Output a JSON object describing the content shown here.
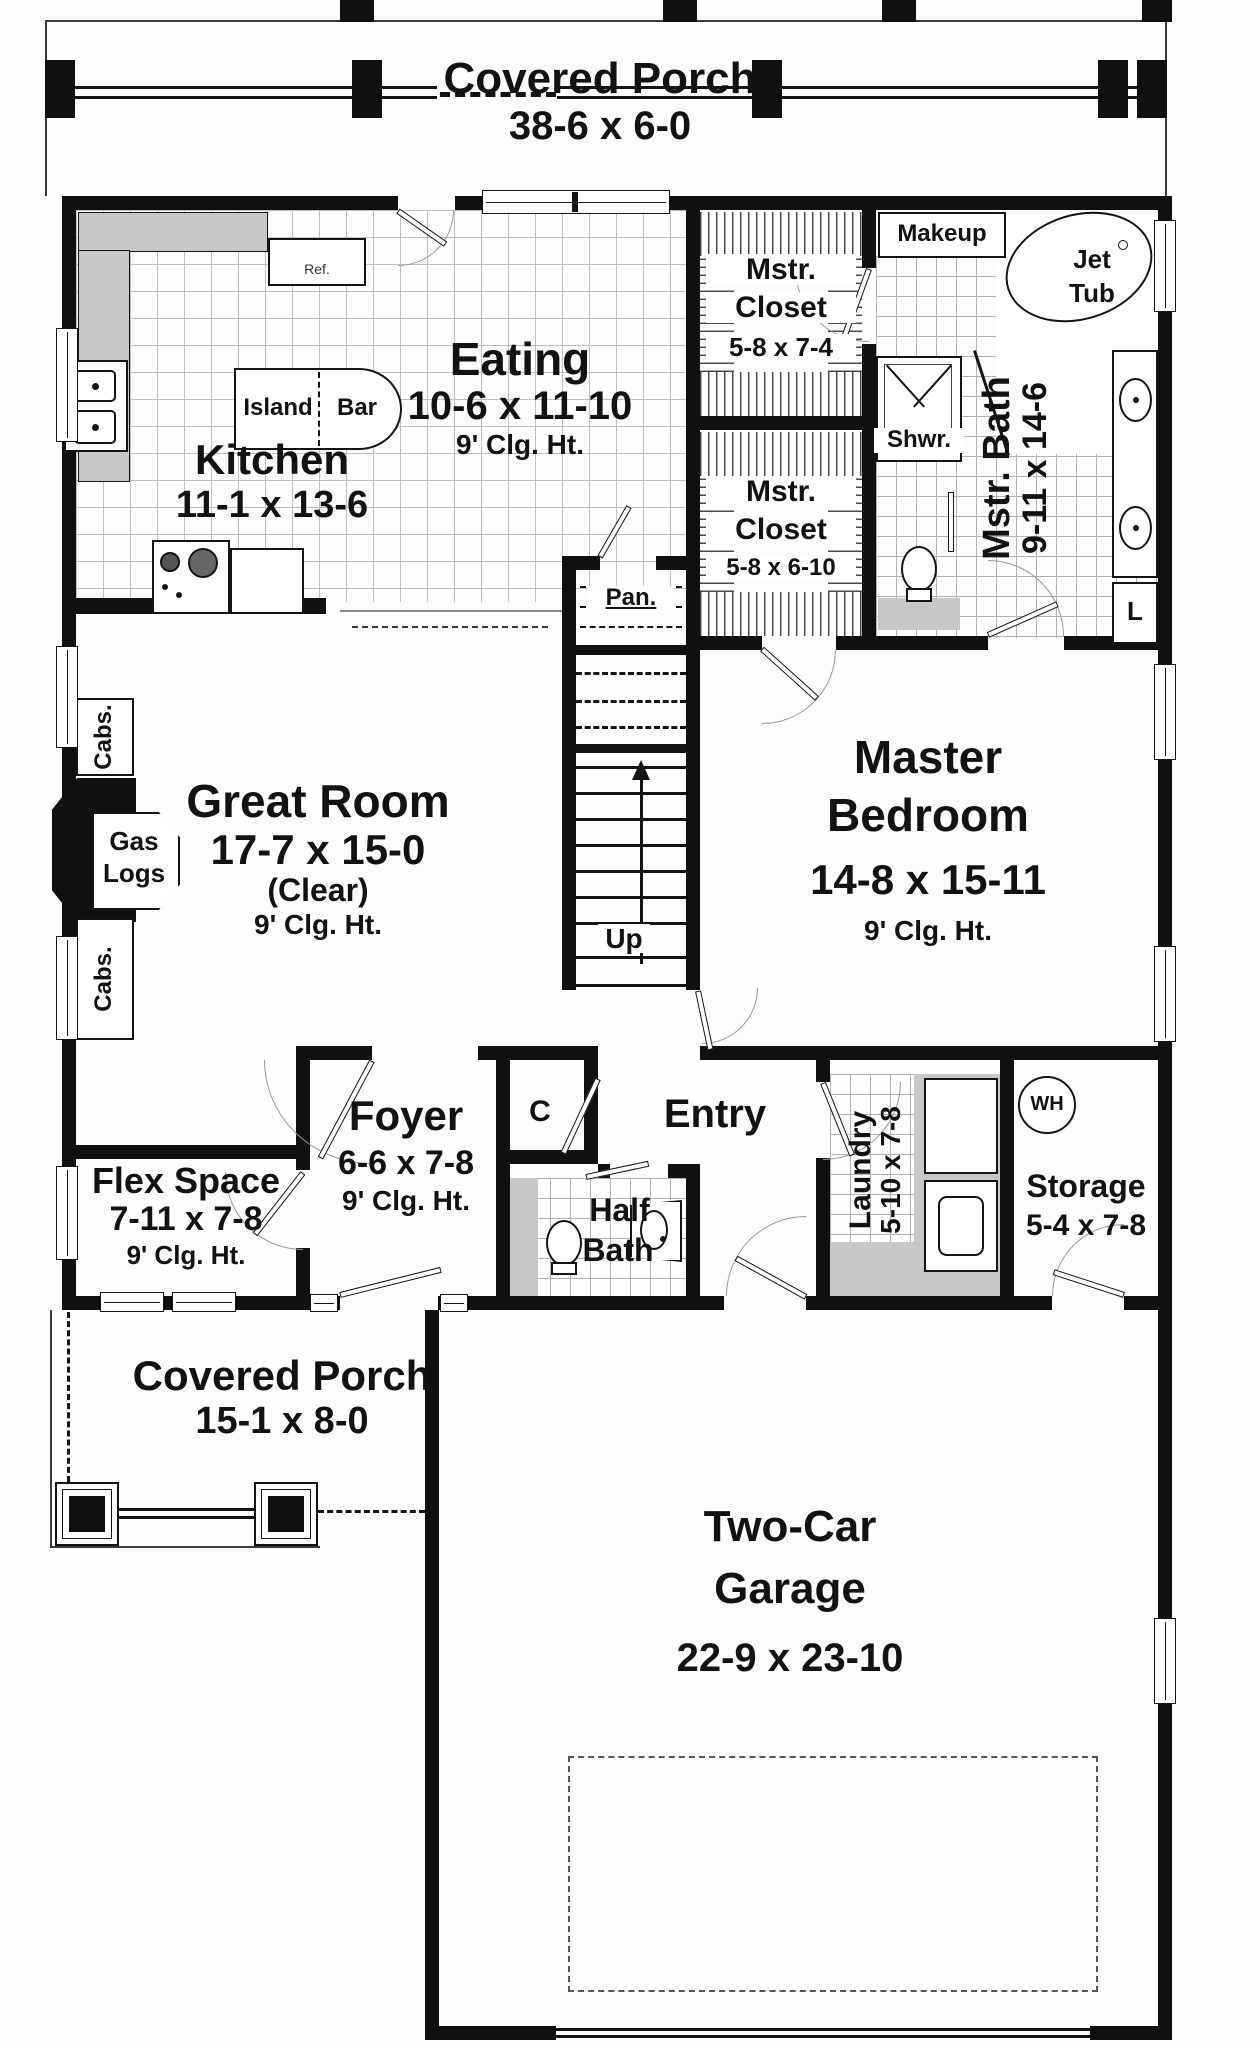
{
  "plan": {
    "porch_top": {
      "name": "Covered Porch",
      "dims": "38-6 x 6-0"
    },
    "eating": {
      "name": "Eating",
      "dims": "10-6 x 11-10",
      "clg": "9' Clg. Ht."
    },
    "kitchen": {
      "name": "Kitchen",
      "dims": "11-1 x 13-6"
    },
    "island": {
      "left": "Island",
      "right": "Bar"
    },
    "ref_label": "Ref.",
    "mstr_closet_1": {
      "line1": "Mstr.",
      "line2": "Closet",
      "dims": "5-8 x 7-4"
    },
    "makeup": "Makeup",
    "jet_tub": {
      "line1": "Jet",
      "line2": "Tub"
    },
    "shower": "Shwr.",
    "mstr_bath": {
      "name": "Mstr. Bath",
      "dims": "9-11 x 14-6"
    },
    "mstr_closet_2": {
      "line1": "Mstr.",
      "line2": "Closet",
      "dims": "5-8 x 6-10"
    },
    "pantry": "Pan.",
    "cabs_top": "Cabs.",
    "cabs_bottom": "Cabs.",
    "gas_logs": {
      "line1": "Gas",
      "line2": "Logs"
    },
    "great_room": {
      "name": "Great Room",
      "dims": "17-7 x 15-0",
      "note": "(Clear)",
      "clg": "9' Clg. Ht."
    },
    "stairs": {
      "label": "Up"
    },
    "master_bedroom": {
      "line1": "Master",
      "line2": "Bedroom",
      "dims": "14-8 x 15-11",
      "clg": "9' Clg. Ht."
    },
    "linen": "L",
    "flex_space": {
      "name": "Flex Space",
      "dims": "7-11 x 7-8",
      "clg": "9' Clg. Ht."
    },
    "foyer": {
      "name": "Foyer",
      "dims": "6-6 x 7-8",
      "clg": "9' Clg. Ht."
    },
    "closet_c": "C",
    "entry": "Entry",
    "half_bath": {
      "line1": "Half",
      "line2": "Bath"
    },
    "laundry": {
      "name": "Laundry",
      "dims": "5-10 x 7-8"
    },
    "water_heater": "WH",
    "storage": {
      "name": "Storage",
      "dims": "5-4 x 7-8"
    },
    "porch_bottom": {
      "name": "Covered Porch",
      "dims": "15-1 x 8-0"
    },
    "garage": {
      "line1": "Two-Car",
      "line2": "Garage",
      "dims": "22-9 x 23-10"
    }
  },
  "colors": {
    "wall": "#101010",
    "counter": "#c7c7c7",
    "tile_line": "#bfbfbf",
    "text": "#121212"
  }
}
